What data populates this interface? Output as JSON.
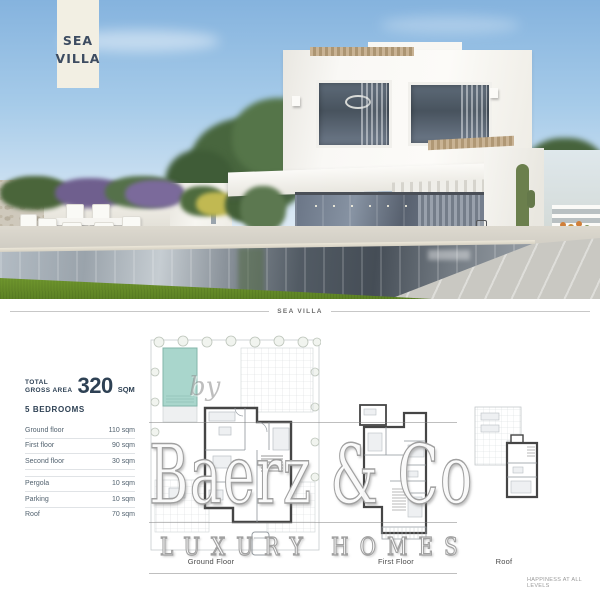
{
  "banner": {
    "line1": "SEA",
    "line2": "VILLA"
  },
  "section_divider": {
    "label": "SEA VILLA"
  },
  "info": {
    "total_label_line1": "TOTAL",
    "total_label_line2": "GROSS AREA",
    "total_value": "320",
    "total_unit": "SQM",
    "bedrooms": "5 BEDROOMS",
    "floors": [
      {
        "label": "Ground floor",
        "value": "110 sqm"
      },
      {
        "label": "First floor",
        "value": "90 sqm"
      },
      {
        "label": "Second floor",
        "value": "30 sqm"
      }
    ],
    "extras": [
      {
        "label": "Pergola",
        "value": "10 sqm"
      },
      {
        "label": "Parking",
        "value": "10 sqm"
      },
      {
        "label": "Roof",
        "value": "70 sqm"
      }
    ]
  },
  "plans": {
    "ground_label": "Ground Floor",
    "first_label": "First Floor",
    "roof_label": "Roof"
  },
  "watermark": {
    "by": "by",
    "name": "Baerz & Co",
    "tagline": "LUXURY HOMES"
  },
  "footer": {
    "note": "HAPPINESS AT ALL LEVELS"
  },
  "colors": {
    "accent_navy": "#2e4154",
    "banner_cream": "#f2efe3",
    "plan_pool_teal": "#a9d6cc",
    "lawn_green": "#6b8f2e",
    "sky_blue": "#9cc4e6"
  }
}
